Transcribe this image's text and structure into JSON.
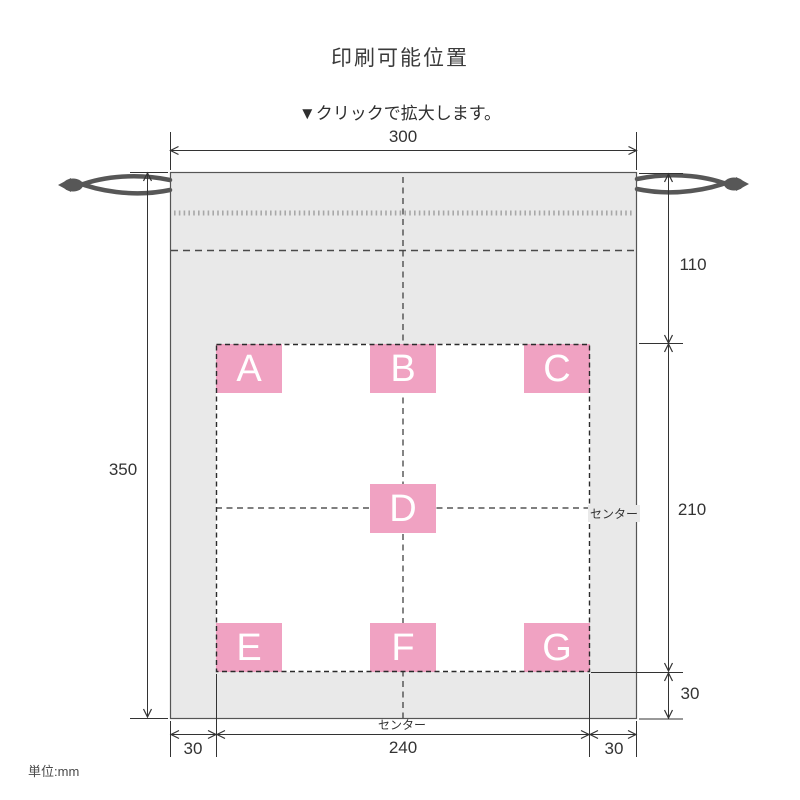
{
  "title": "印刷可能位置",
  "subtitle": "▼クリックで拡大します。",
  "unit_note": "単位:mm",
  "print_positions": [
    "A",
    "B",
    "C",
    "D",
    "E",
    "F",
    "G"
  ],
  "dimensions": {
    "bag_width_mm": "300",
    "bag_height_mm": "350",
    "top_to_print_area_mm": "110",
    "print_area_height_mm": "210",
    "print_area_bottom_margin_mm": "30",
    "bottom_left_margin_mm": "30",
    "print_area_width_mm": "240",
    "bottom_right_margin_mm": "30"
  },
  "center_labels": {
    "right": "センター",
    "bottom": "センター"
  },
  "colors": {
    "bag_fill": "#e9e9e9",
    "print_position_pink": "#f0a2c2",
    "cord_gray": "#575757",
    "line_dark": "#333333"
  }
}
